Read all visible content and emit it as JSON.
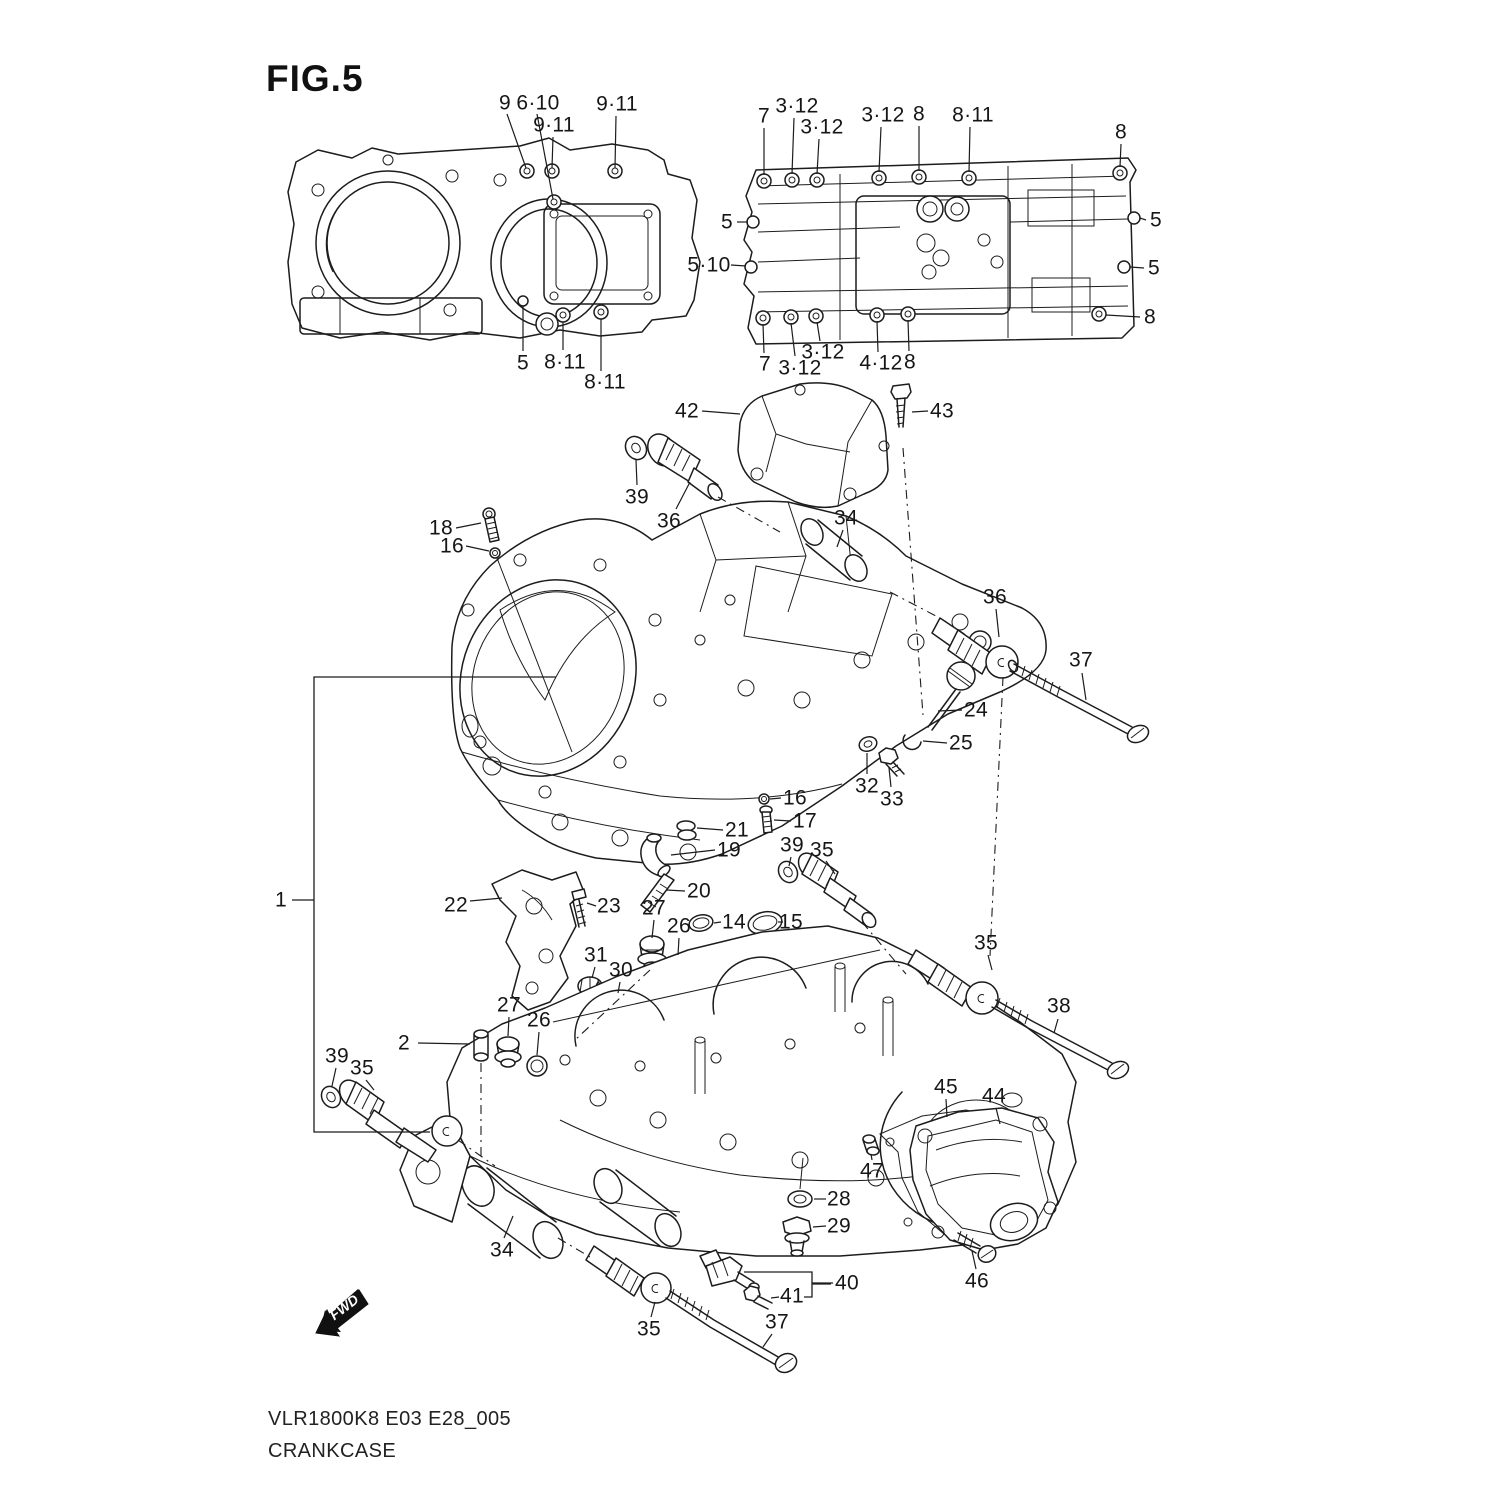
{
  "title": "FIG.5",
  "footer": {
    "line1": "VLR1800K8 E03 E28_005",
    "line2": "CRANKCASE"
  },
  "fwd_label": "FWD",
  "colors": {
    "ink": "#1c1c1c",
    "bg": "#ffffff"
  },
  "callouts": [
    {
      "text": "9",
      "x": 505,
      "y": 103,
      "leader": [
        [
          507,
          114
        ],
        [
          526,
          168
        ]
      ]
    },
    {
      "text": "6·10",
      "x": 538,
      "y": 103,
      "leader": [
        [
          537,
          114
        ],
        [
          553,
          199
        ]
      ]
    },
    {
      "text": "9·11",
      "x": 554,
      "y": 125,
      "leader": [
        [
          553,
          137
        ],
        [
          552,
          168
        ]
      ]
    },
    {
      "text": "9·11",
      "x": 617,
      "y": 104,
      "leader": [
        [
          616,
          116
        ],
        [
          615,
          168
        ]
      ]
    },
    {
      "text": "5",
      "x": 523,
      "y": 363,
      "leader": [
        [
          523,
          351
        ],
        [
          523,
          306
        ]
      ]
    },
    {
      "text": "8·11",
      "x": 565,
      "y": 362,
      "leader": [
        [
          563,
          350
        ],
        [
          563,
          322
        ]
      ]
    },
    {
      "text": "8·11",
      "x": 605,
      "y": 382,
      "leader": [
        [
          601,
          371
        ],
        [
          601,
          319
        ]
      ]
    },
    {
      "text": "5",
      "x": 727,
      "y": 222,
      "leader": [
        [
          737,
          222
        ],
        [
          748,
          222
        ]
      ]
    },
    {
      "text": "5·10",
      "x": 709,
      "y": 265,
      "leader": [
        [
          731,
          265
        ],
        [
          746,
          266
        ]
      ]
    },
    {
      "text": "7",
      "x": 764,
      "y": 116,
      "leader": [
        [
          764,
          128
        ],
        [
          764,
          175
        ]
      ]
    },
    {
      "text": "3·12",
      "x": 797,
      "y": 106,
      "leader": [
        [
          794,
          118
        ],
        [
          792,
          174
        ]
      ]
    },
    {
      "text": "3·12",
      "x": 822,
      "y": 127,
      "leader": [
        [
          819,
          139
        ],
        [
          817,
          174
        ]
      ]
    },
    {
      "text": "3·12",
      "x": 883,
      "y": 115,
      "leader": [
        [
          881,
          127
        ],
        [
          879,
          172
        ]
      ]
    },
    {
      "text": "8",
      "x": 919,
      "y": 114,
      "leader": [
        [
          919,
          126
        ],
        [
          919,
          171
        ]
      ]
    },
    {
      "text": "8·11",
      "x": 973,
      "y": 115,
      "leader": [
        [
          970,
          127
        ],
        [
          969,
          172
        ]
      ]
    },
    {
      "text": "8",
      "x": 1121,
      "y": 132,
      "leader": [
        [
          1121,
          144
        ],
        [
          1120,
          167
        ]
      ]
    },
    {
      "text": "5",
      "x": 1156,
      "y": 220,
      "leader": [
        [
          1146,
          220
        ],
        [
          1140,
          218
        ]
      ]
    },
    {
      "text": "5",
      "x": 1154,
      "y": 268,
      "leader": [
        [
          1144,
          268
        ],
        [
          1130,
          267
        ]
      ]
    },
    {
      "text": "8",
      "x": 1150,
      "y": 317,
      "leader": [
        [
          1140,
          317
        ],
        [
          1106,
          315
        ]
      ]
    },
    {
      "text": "7",
      "x": 765,
      "y": 364,
      "leader": [
        [
          764,
          353
        ],
        [
          763,
          324
        ]
      ]
    },
    {
      "text": "3·12",
      "x": 800,
      "y": 368,
      "leader": [
        [
          795,
          356
        ],
        [
          791,
          323
        ]
      ]
    },
    {
      "text": "3·12",
      "x": 823,
      "y": 352,
      "leader": [
        [
          820,
          341
        ],
        [
          817,
          322
        ]
      ]
    },
    {
      "text": "4·12",
      "x": 881,
      "y": 363,
      "leader": [
        [
          878,
          352
        ],
        [
          877,
          321
        ]
      ]
    },
    {
      "text": "8",
      "x": 910,
      "y": 362,
      "leader": [
        [
          909,
          351
        ],
        [
          908,
          320
        ]
      ]
    },
    {
      "text": "42",
      "x": 687,
      "y": 411,
      "leader": [
        [
          702,
          411
        ],
        [
          740,
          414
        ]
      ]
    },
    {
      "text": "43",
      "x": 942,
      "y": 411,
      "leader": [
        [
          928,
          411
        ],
        [
          912,
          412
        ]
      ]
    },
    {
      "text": "39",
      "x": 637,
      "y": 497,
      "leader": [
        [
          637,
          485
        ],
        [
          636,
          460
        ]
      ]
    },
    {
      "text": "36",
      "x": 669,
      "y": 521,
      "leader": [
        [
          676,
          509
        ],
        [
          690,
          482
        ]
      ]
    },
    {
      "text": "34",
      "x": 846,
      "y": 518,
      "leader": [
        [
          843,
          530
        ],
        [
          837,
          547
        ]
      ]
    },
    {
      "text": "18",
      "x": 441,
      "y": 528,
      "leader": [
        [
          456,
          528
        ],
        [
          481,
          523
        ]
      ]
    },
    {
      "text": "16",
      "x": 452,
      "y": 546,
      "leader": [
        [
          466,
          546
        ],
        [
          489,
          551
        ]
      ]
    },
    {
      "text": "36",
      "x": 995,
      "y": 597,
      "leader": [
        [
          996,
          609
        ],
        [
          999,
          637
        ]
      ]
    },
    {
      "text": "37",
      "x": 1081,
      "y": 660,
      "leader": [
        [
          1082,
          673
        ],
        [
          1086,
          700
        ]
      ]
    },
    {
      "text": "24",
      "x": 976,
      "y": 710,
      "leader": [
        [
          962,
          710
        ],
        [
          938,
          711
        ]
      ]
    },
    {
      "text": "25",
      "x": 961,
      "y": 743,
      "leader": [
        [
          947,
          743
        ],
        [
          923,
          741
        ]
      ]
    },
    {
      "text": "32",
      "x": 867,
      "y": 786,
      "leader": [
        [
          867,
          774
        ],
        [
          867,
          753
        ]
      ]
    },
    {
      "text": "33",
      "x": 892,
      "y": 799,
      "leader": [
        [
          891,
          787
        ],
        [
          889,
          768
        ]
      ]
    },
    {
      "text": "16",
      "x": 795,
      "y": 798,
      "leader": [
        [
          781,
          798
        ],
        [
          770,
          799
        ]
      ]
    },
    {
      "text": "17",
      "x": 805,
      "y": 821,
      "leader": [
        [
          791,
          821
        ],
        [
          774,
          820
        ]
      ]
    },
    {
      "text": "21",
      "x": 737,
      "y": 830,
      "leader": [
        [
          723,
          830
        ],
        [
          697,
          828
        ]
      ]
    },
    {
      "text": "19",
      "x": 729,
      "y": 850,
      "leader": [
        [
          715,
          850
        ],
        [
          671,
          855
        ]
      ]
    },
    {
      "text": "39",
      "x": 792,
      "y": 845,
      "leader": [
        [
          791,
          857
        ],
        [
          789,
          866
        ]
      ]
    },
    {
      "text": "35",
      "x": 822,
      "y": 850,
      "leader": [
        [
          826,
          861
        ],
        [
          835,
          874
        ]
      ]
    },
    {
      "text": "20",
      "x": 699,
      "y": 891,
      "leader": [
        [
          685,
          891
        ],
        [
          666,
          890
        ]
      ]
    },
    {
      "text": "22",
      "x": 456,
      "y": 905,
      "leader": [
        [
          470,
          901
        ],
        [
          502,
          898
        ]
      ]
    },
    {
      "text": "23",
      "x": 609,
      "y": 906,
      "leader": [
        [
          596,
          906
        ],
        [
          587,
          903
        ]
      ]
    },
    {
      "text": "27",
      "x": 654,
      "y": 908,
      "leader": [
        [
          654,
          920
        ],
        [
          652,
          938
        ]
      ]
    },
    {
      "text": "26",
      "x": 679,
      "y": 926,
      "leader": [
        [
          679,
          938
        ],
        [
          678,
          955
        ]
      ]
    },
    {
      "text": "14",
      "x": 734,
      "y": 922,
      "leader": [
        [
          721,
          922
        ],
        [
          714,
          923
        ]
      ]
    },
    {
      "text": "15",
      "x": 791,
      "y": 922,
      "leader": [
        [
          778,
          922
        ],
        [
          783,
          922
        ]
      ]
    },
    {
      "text": "31",
      "x": 596,
      "y": 955,
      "leader": [
        [
          595,
          967
        ],
        [
          592,
          978
        ]
      ]
    },
    {
      "text": "30",
      "x": 621,
      "y": 970,
      "leader": [
        [
          620,
          982
        ],
        [
          618,
          993
        ]
      ]
    },
    {
      "text": "1",
      "x": 281,
      "y": 900,
      "leader": [
        [
          292,
          900
        ],
        [
          314,
          900
        ]
      ]
    },
    {
      "text": "27",
      "x": 509,
      "y": 1005,
      "leader": [
        [
          509,
          1017
        ],
        [
          508,
          1036
        ]
      ]
    },
    {
      "text": "26",
      "x": 539,
      "y": 1020,
      "leader": [
        [
          539,
          1032
        ],
        [
          537,
          1055
        ]
      ]
    },
    {
      "text": "2",
      "x": 404,
      "y": 1043,
      "leader": [
        [
          418,
          1043
        ],
        [
          470,
          1044
        ]
      ]
    },
    {
      "text": "39",
      "x": 337,
      "y": 1056,
      "leader": [
        [
          336,
          1068
        ],
        [
          332,
          1086
        ]
      ]
    },
    {
      "text": "35",
      "x": 362,
      "y": 1068,
      "leader": [
        [
          366,
          1080
        ],
        [
          374,
          1090
        ]
      ]
    },
    {
      "text": "35",
      "x": 986,
      "y": 943,
      "leader": [
        [
          988,
          955
        ],
        [
          992,
          970
        ]
      ]
    },
    {
      "text": "38",
      "x": 1059,
      "y": 1006,
      "leader": [
        [
          1058,
          1019
        ],
        [
          1054,
          1033
        ]
      ]
    },
    {
      "text": "45",
      "x": 946,
      "y": 1087,
      "leader": [
        [
          946,
          1099
        ],
        [
          947,
          1117
        ]
      ]
    },
    {
      "text": "44",
      "x": 994,
      "y": 1096,
      "leader": [
        [
          996,
          1108
        ],
        [
          1000,
          1124
        ]
      ]
    },
    {
      "text": "47",
      "x": 872,
      "y": 1171,
      "leader": [
        [
          872,
          1160
        ],
        [
          871,
          1154
        ]
      ]
    },
    {
      "text": "28",
      "x": 839,
      "y": 1199,
      "leader": [
        [
          826,
          1199
        ],
        [
          814,
          1199
        ]
      ]
    },
    {
      "text": "29",
      "x": 839,
      "y": 1226,
      "leader": [
        [
          826,
          1226
        ],
        [
          813,
          1227
        ]
      ]
    },
    {
      "text": "46",
      "x": 977,
      "y": 1281,
      "leader": [
        [
          976,
          1269
        ],
        [
          972,
          1251
        ]
      ]
    },
    {
      "text": "40",
      "x": 847,
      "y": 1283,
      "leader": [
        [
          833,
          1283
        ],
        [
          812,
          1283
        ]
      ]
    },
    {
      "text": "41",
      "x": 792,
      "y": 1296,
      "leader": [
        [
          779,
          1297
        ],
        [
          771,
          1298
        ]
      ]
    },
    {
      "text": "34",
      "x": 502,
      "y": 1250,
      "leader": [
        [
          504,
          1238
        ],
        [
          513,
          1216
        ]
      ]
    },
    {
      "text": "35",
      "x": 649,
      "y": 1329,
      "leader": [
        [
          651,
          1317
        ],
        [
          655,
          1302
        ]
      ]
    },
    {
      "text": "37",
      "x": 777,
      "y": 1322,
      "leader": [
        [
          772,
          1334
        ],
        [
          763,
          1347
        ]
      ]
    }
  ],
  "brackets": [
    {
      "name": "part-1-bracket",
      "points": [
        [
          556,
          677
        ],
        [
          314,
          677
        ],
        [
          314,
          1132
        ],
        [
          430,
          1132
        ]
      ]
    },
    {
      "name": "part-40-bracket",
      "points": [
        [
          744,
          1272
        ],
        [
          812,
          1272
        ],
        [
          812,
          1297
        ],
        [
          804,
          1297
        ]
      ]
    },
    {
      "name": "part-40-dash",
      "points": [
        [
          812,
          1284
        ],
        [
          831,
          1284
        ]
      ]
    }
  ]
}
